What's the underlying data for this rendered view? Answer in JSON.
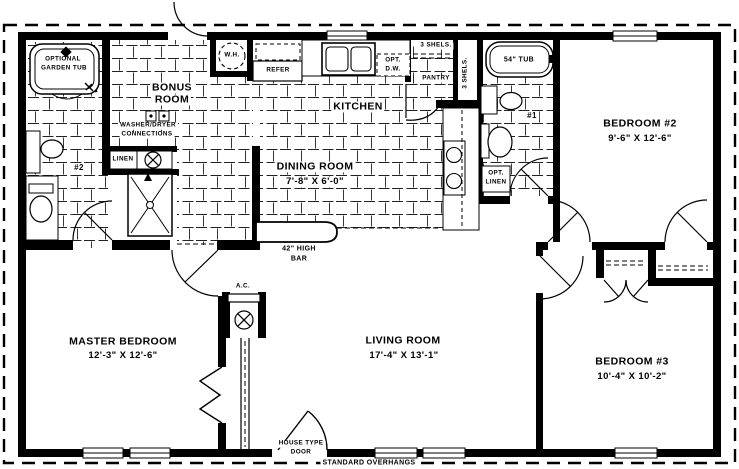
{
  "plan": {
    "rooms": {
      "bonus_room": {
        "name_line1": "BONUS",
        "name_line2": "ROOM"
      },
      "kitchen": {
        "name": "KITCHEN"
      },
      "dining_room": {
        "name": "DINING ROOM",
        "dims": "7'-8\" X 6'-0\""
      },
      "master_bedroom": {
        "name": "MASTER BEDROOM",
        "dims": "12'-3\" X 12'-6\""
      },
      "living_room": {
        "name": "LIVING ROOM",
        "dims": "17'-4\" X 13'-1\""
      },
      "bedroom_2": {
        "name": "BEDROOM #2",
        "dims": "9'-6\" X 12'-6\""
      },
      "bedroom_3": {
        "name": "BEDROOM #3",
        "dims": "10'-4\" X 10'-2\""
      },
      "pantry": {
        "name": "PANTRY",
        "shelves_top": "3 SHELS.",
        "shelves_side": "3 SHELS."
      },
      "bath_1": {
        "number": "#1",
        "tub": "54\" TUB",
        "opt_linen_line1": "OPT.",
        "opt_linen_line2": "LINEN"
      },
      "bath_2": {
        "number": "#2",
        "garden_tub_line1": "OPTIONAL",
        "garden_tub_line2": "GARDEN TUB",
        "linen": "LINEN"
      }
    },
    "fixtures": {
      "water_heater": "W.H.",
      "refrigerator": "REFER",
      "dishwasher_line1": "OPT.",
      "dishwasher_line2": "D.W.",
      "washer_dryer_line1": "WASHER/DRYER",
      "washer_dryer_line2": "CONNECTIONS",
      "ac_unit": "A.C.",
      "bar_line1": "42\" HIGH",
      "bar_line2": "BAR"
    },
    "annotations": {
      "entry_door_line1": "HOUSE TYPE",
      "entry_door_line2": "DOOR",
      "overhangs": "STANDARD OVERHANGS"
    },
    "colors": {
      "wall": "#000000",
      "background": "#ffffff",
      "tile_line": "#222222"
    }
  }
}
